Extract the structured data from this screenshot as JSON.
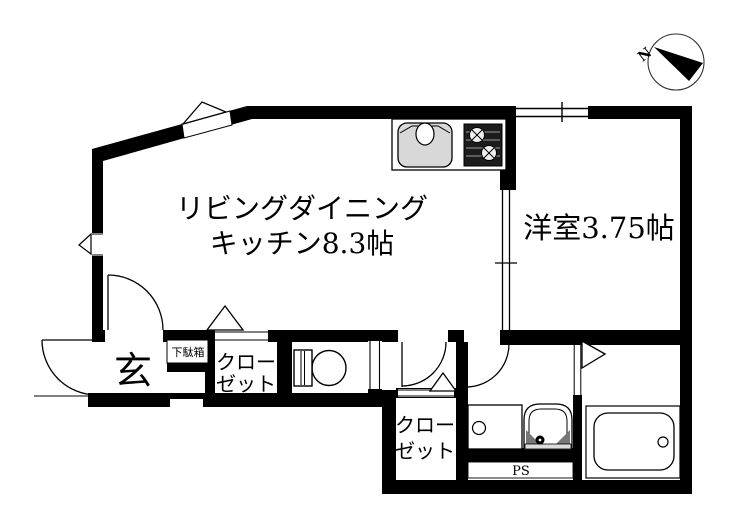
{
  "palette": {
    "background": "#ffffff",
    "wall": "#000000",
    "sink_fill": "#d8d8d8",
    "stove_fill": "#1c1c1c",
    "basin_corner_fill": "#777777"
  },
  "compass": {
    "north_label": "N"
  },
  "rooms": {
    "ldk": {
      "label_line1": "リビングダイニング",
      "label_line2": "キッチン8.3帖"
    },
    "western": {
      "label": "洋室3.75帖"
    },
    "entrance": {
      "label": "玄"
    },
    "shoe_cabinet": {
      "label": "下駄箱"
    },
    "closet_hall": {
      "label_line1": "クロー",
      "label_line2": "ゼット"
    },
    "closet_lower": {
      "label_line1": "クロー",
      "label_line2": "ゼット"
    },
    "pipe_space": {
      "label": "PS"
    }
  },
  "icons": {
    "compass": "compass-north-icon",
    "kitchen_sink": "kitchen-sink-icon",
    "gas_stove": "gas-stove-icon",
    "toilet": "toilet-icon",
    "washing_machine_pan": "washing-machine-pan-icon",
    "washbasin": "washbasin-icon",
    "bathtub": "bathtub-icon"
  }
}
